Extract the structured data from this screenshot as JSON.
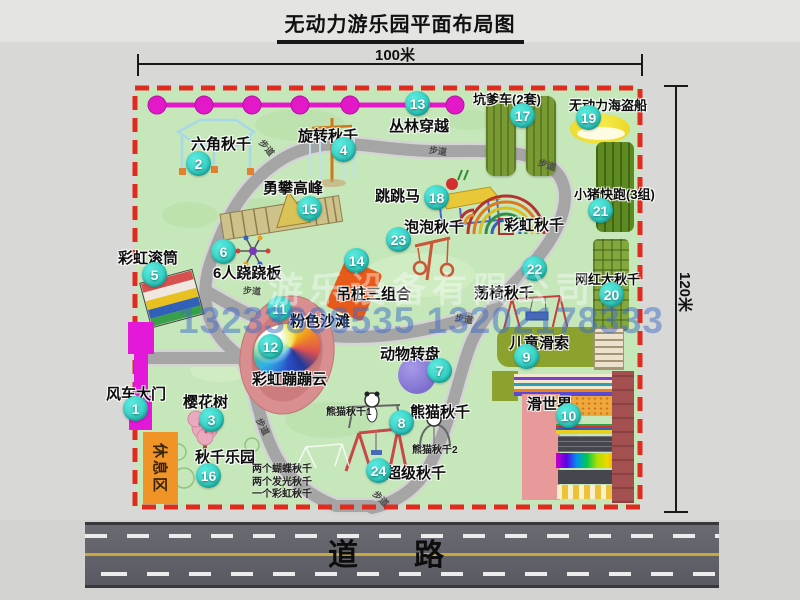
{
  "title": "无动力游乐园平面布局图",
  "dimensions": {
    "top": "100米",
    "right": "120米"
  },
  "road": {
    "label": "道路"
  },
  "watermark": {
    "company": "游乐设备有限公司",
    "phone": "13233806535 13202178333"
  },
  "path_label": "步道",
  "rest_area": {
    "label": "休息区"
  },
  "rainbow_swing_label": "彩虹秋千",
  "attractions": [
    {
      "num": "1",
      "label": "风车大门"
    },
    {
      "num": "2",
      "label": "六角秋千"
    },
    {
      "num": "3",
      "label": "樱花树"
    },
    {
      "num": "4",
      "label": "旋转秋千"
    },
    {
      "num": "5",
      "label": "彩虹滚筒"
    },
    {
      "num": "6",
      "label": "6人跷跷板"
    },
    {
      "num": "7",
      "label": "动物转盘"
    },
    {
      "num": "8",
      "label": "熊猫秋千"
    },
    {
      "num": "9",
      "label": "儿童滑索"
    },
    {
      "num": "10",
      "label": "滑世界"
    },
    {
      "num": "11",
      "label": "粉色沙滩"
    },
    {
      "num": "12",
      "label": "彩虹蹦蹦云"
    },
    {
      "num": "13",
      "label": "丛林穿越"
    },
    {
      "num": "14",
      "label": "吊桩三组合"
    },
    {
      "num": "15",
      "label": "勇攀高峰"
    },
    {
      "num": "16",
      "label": "秋千乐园"
    },
    {
      "num": "17",
      "label": "坑爹车(2套)"
    },
    {
      "num": "18",
      "label": "跳跳马"
    },
    {
      "num": "19",
      "label": "无动力海盗船"
    },
    {
      "num": "20",
      "label": "网红大秋千"
    },
    {
      "num": "21",
      "label": "小猪快跑(3组)"
    },
    {
      "num": "22",
      "label": "荡椅秋千"
    },
    {
      "num": "23",
      "label": "泡泡秋千"
    },
    {
      "num": "24",
      "label": "超级秋千"
    }
  ],
  "notes": {
    "swing_park": [
      "两个蝴蝶秋千",
      "两个发光秋千",
      "一个彩虹秋千"
    ],
    "panda": [
      "熊猫秋千1",
      "熊猫秋千2"
    ]
  },
  "colors": {
    "map_green": "#c6e7ba",
    "border_red": "#e02b20",
    "badge_teal": "#2cc9bd",
    "jungle_magenta": "#e318c8",
    "road_gray": "#62626a",
    "rest_orange": "#f09428"
  }
}
